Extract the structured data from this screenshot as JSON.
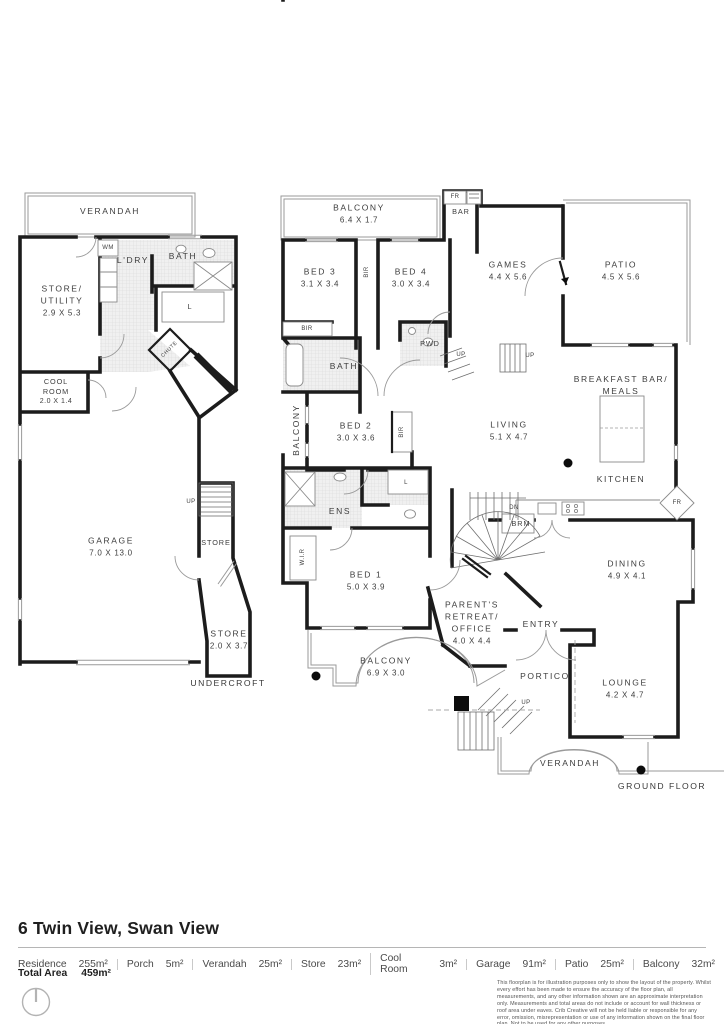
{
  "plan": {
    "uc": {
      "floor": "UNDERCROFT",
      "verandah": [
        "VERANDAH"
      ],
      "store_utility": [
        "STORE/",
        "UTILITY",
        "2.9 X 5.3"
      ],
      "ldry": [
        "L'DRY"
      ],
      "bath": [
        "BATH"
      ],
      "wm": [
        "WM"
      ],
      "linen": [
        "L"
      ],
      "chute": [
        "CHUTE"
      ],
      "cool": [
        "COOL",
        "ROOM",
        "2.0 X 1.4"
      ],
      "garage": [
        "GARAGE",
        "7.0 X 13.0"
      ],
      "store1": [
        "STORE"
      ],
      "store2": [
        "STORE",
        "2.0 X 3.7"
      ],
      "up": [
        "UP"
      ]
    },
    "gf": {
      "floor": "GROUND FLOOR",
      "balcony_top": [
        "BALCONY",
        "6.4 X 1.7"
      ],
      "fr1": [
        "FR"
      ],
      "bar": [
        "BAR"
      ],
      "bed3": [
        "BED 3",
        "3.1 X 3.4"
      ],
      "bir1": [
        "BIR"
      ],
      "bed4": [
        "BED 4",
        "3.0 X 3.4"
      ],
      "games": [
        "GAMES",
        "4.4 X 5.6"
      ],
      "patio": [
        "PATIO",
        "4.5 X 5.6"
      ],
      "bir2": [
        "BIR"
      ],
      "bath": [
        "BATH"
      ],
      "pwd": [
        "PWD"
      ],
      "up1": [
        "UP"
      ],
      "up2": [
        "UP"
      ],
      "balcony_side": [
        "BALCONY"
      ],
      "bed2": [
        "BED 2",
        "3.0 X 3.6"
      ],
      "bir3": [
        "BIR"
      ],
      "living": [
        "LIVING",
        "5.1 X 4.7"
      ],
      "breakfast": [
        "BREAKFAST BAR/",
        "MEALS"
      ],
      "kitchen": [
        "KITCHEN"
      ],
      "fr2": [
        "FR"
      ],
      "dn": [
        "DN"
      ],
      "brm": [
        "BRM"
      ],
      "ens": [
        "ENS"
      ],
      "linen": [
        "L"
      ],
      "wir": [
        "W.I.R"
      ],
      "bed1": [
        "BED 1",
        "5.0 X 3.9"
      ],
      "parents": [
        "PARENT'S",
        "RETREAT/",
        "OFFICE",
        "4.0 X 4.4"
      ],
      "balcony_b": [
        "BALCONY",
        "6.9 X 3.0"
      ],
      "entry": [
        "ENTRY"
      ],
      "portico": [
        "PORTICO"
      ],
      "up3": [
        "UP"
      ],
      "dining": [
        "DINING",
        "4.9 X 4.1"
      ],
      "lounge": [
        "LOUNGE",
        "4.2 X 4.7"
      ],
      "verandah": [
        "VERANDAH"
      ]
    }
  },
  "footer": {
    "address": "6 Twin View, Swan View",
    "areas": [
      {
        "label": "Residence",
        "value": "255m²"
      },
      {
        "label": "Porch",
        "value": "5m²"
      },
      {
        "label": "Verandah",
        "value": "25m²"
      },
      {
        "label": "Store",
        "value": "23m²"
      },
      {
        "label": "Cool Room",
        "value": "3m²"
      },
      {
        "label": "Garage",
        "value": "91m²"
      },
      {
        "label": "Patio",
        "value": "25m²"
      },
      {
        "label": "Balcony",
        "value": "32m²"
      }
    ],
    "total_label": "Total Area",
    "total_value": "459m²",
    "disclaimer": "This floorplan is for illustration purposes only to show the layout of the property. Whilst every effort has been made to ensure the accuracy of the floor plan, all measurements, and any other information shown are an approximate interpretation only. Measurements and total areas do not include or account for wall thickness or roof area under eaves. Crib Creative will not be held liable or responsible for any error, omission, misrepresentation or use of any information shown on the final floor plan. Not to be used for any other purposes.",
    "website": "www.cribcreative.com.au"
  }
}
